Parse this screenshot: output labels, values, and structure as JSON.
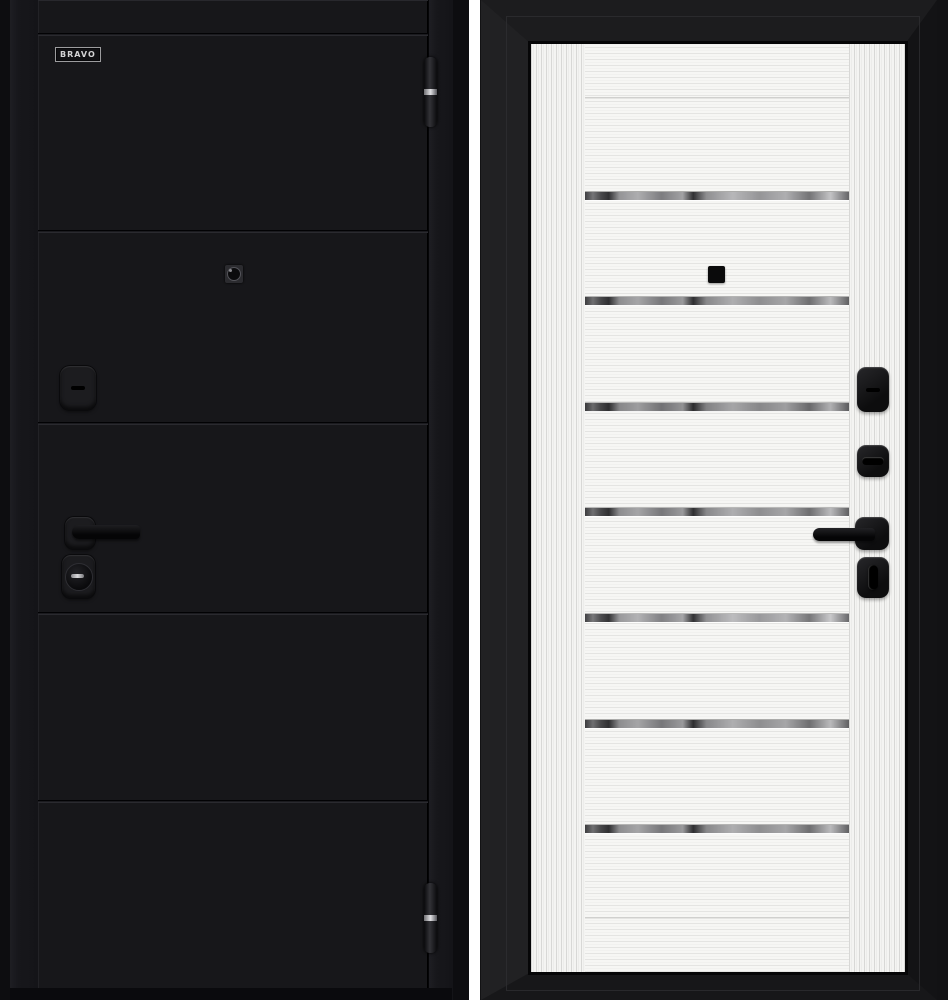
{
  "brand": {
    "logo_text": "BRAVO"
  },
  "product_views": [
    {
      "name": "exterior-side",
      "finish": "black",
      "finish_color": "#17171a",
      "panel_groove_count": 5,
      "hardware": [
        "top-hinge",
        "bottom-hinge",
        "peephole",
        "keyhole-escutcheon",
        "lever-handle",
        "cylinder-lock"
      ]
    },
    {
      "name": "interior-side",
      "finish": "white",
      "finish_color": "#f5f5f3",
      "glass_strip_count": 7,
      "hardware": [
        "peephole",
        "keyhole-escutcheon",
        "thumbturn",
        "lever-handle",
        "night-latch"
      ]
    }
  ],
  "colors": {
    "page_background": "#ffffff",
    "exterior_leaf": "#17171a",
    "interior_leaf": "#f5f5f3",
    "frame_black": "#1c1c1e",
    "chrome_strip": "#a8a8aa",
    "hardware_black": "#111113",
    "hinge_band_silver": "#d9d9dc"
  }
}
